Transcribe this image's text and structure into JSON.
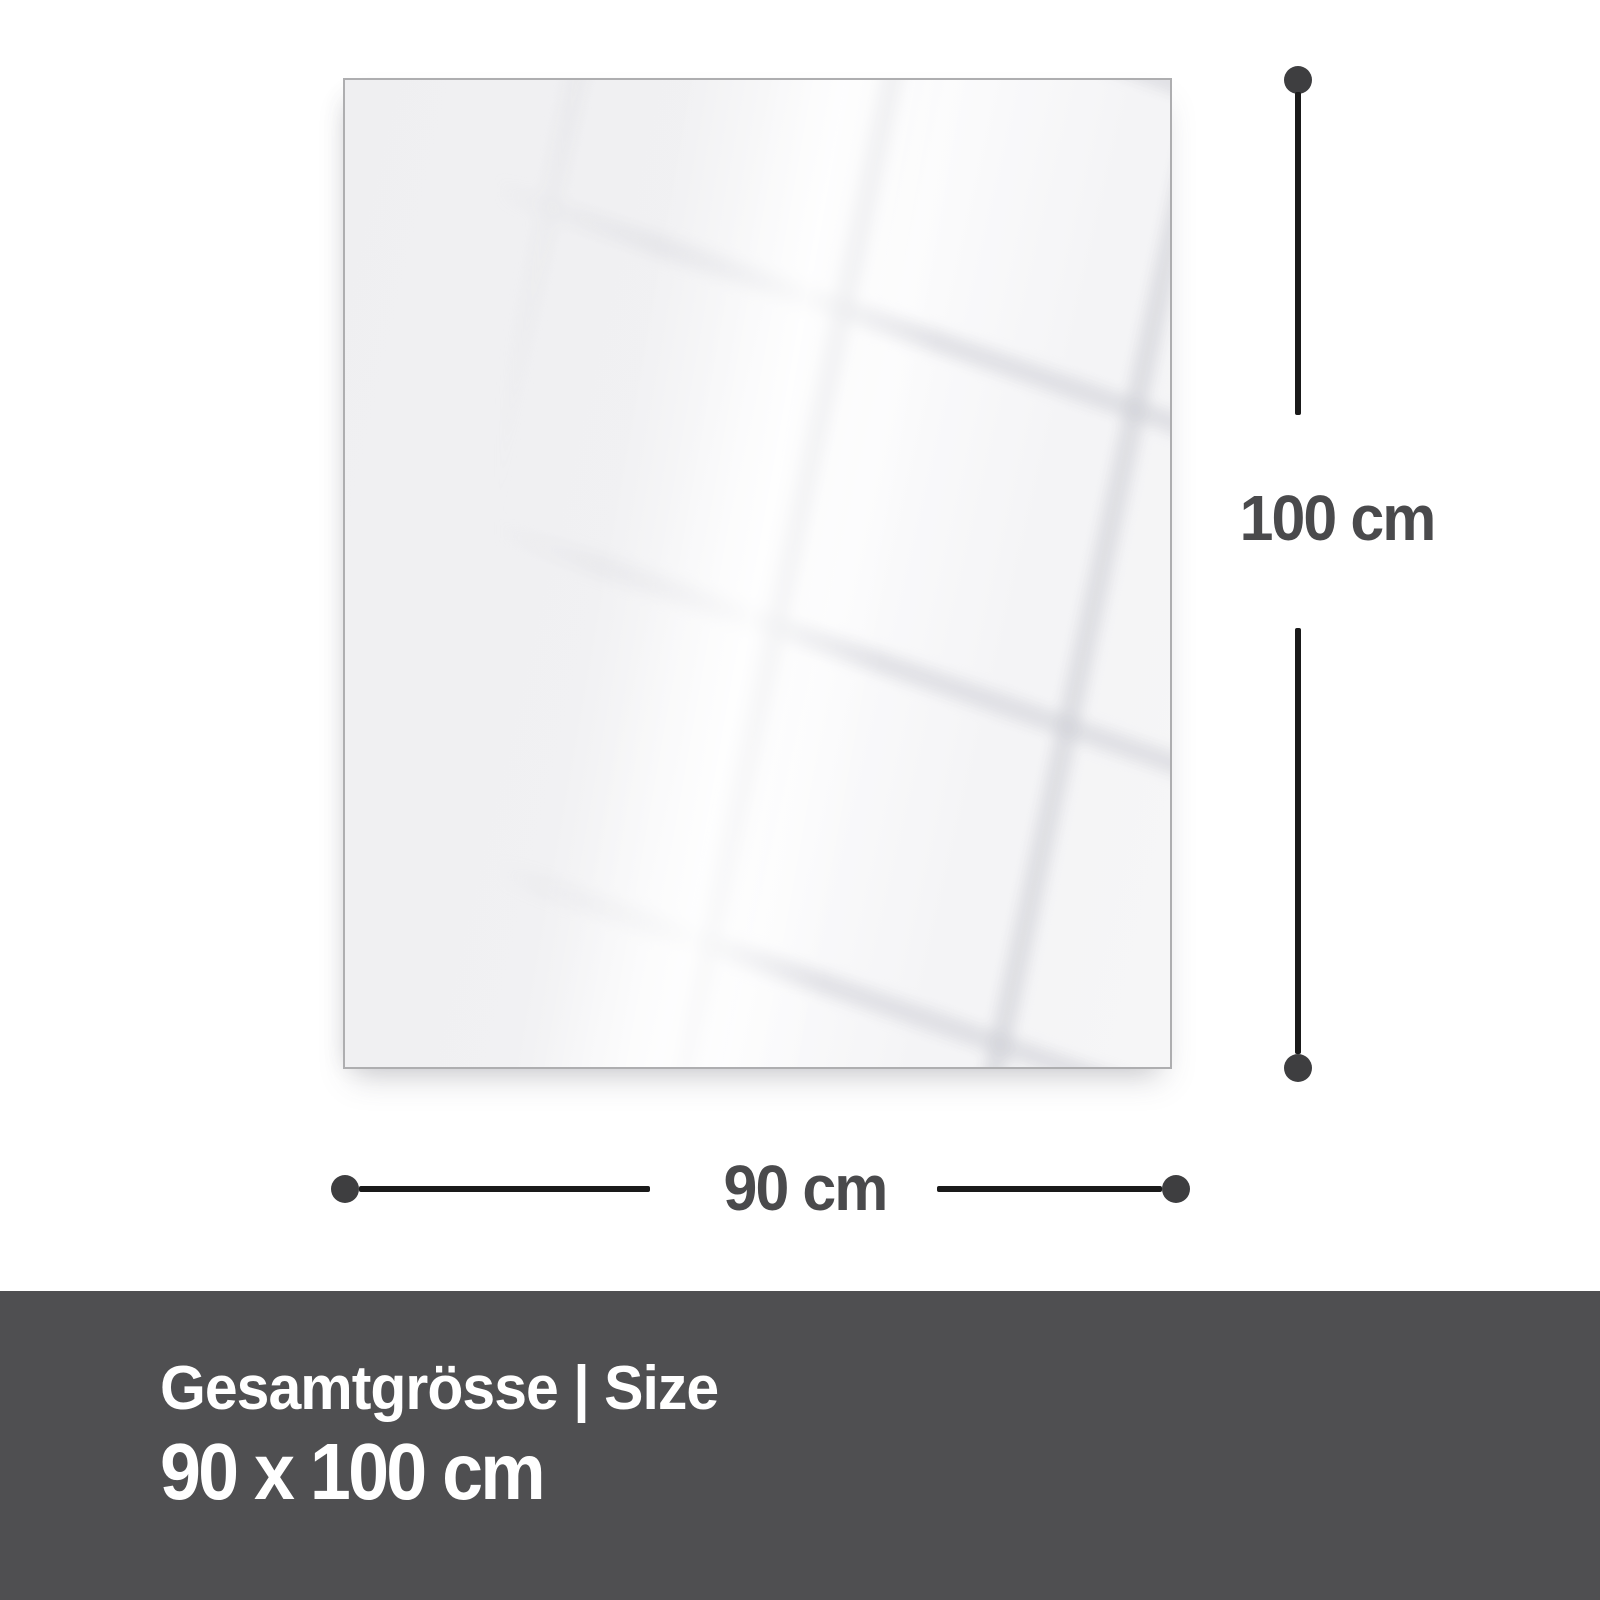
{
  "diagram": {
    "height_dimension": {
      "label": "100 cm"
    },
    "width_dimension": {
      "label": "90 cm"
    }
  },
  "footer": {
    "caption": "Gesamtgrösse | Size",
    "size_value": "90 x 100 cm"
  },
  "colors": {
    "background": "#ffffff",
    "panel_fill": "#f2f2f4",
    "panel_border": "#aeaeb0",
    "dimension_line": "#1a1a1a",
    "dimension_dot": "#3e3e40",
    "dimension_text": "#4a4a4c",
    "footer_background": "#4f4f51",
    "footer_text": "#ffffff"
  }
}
